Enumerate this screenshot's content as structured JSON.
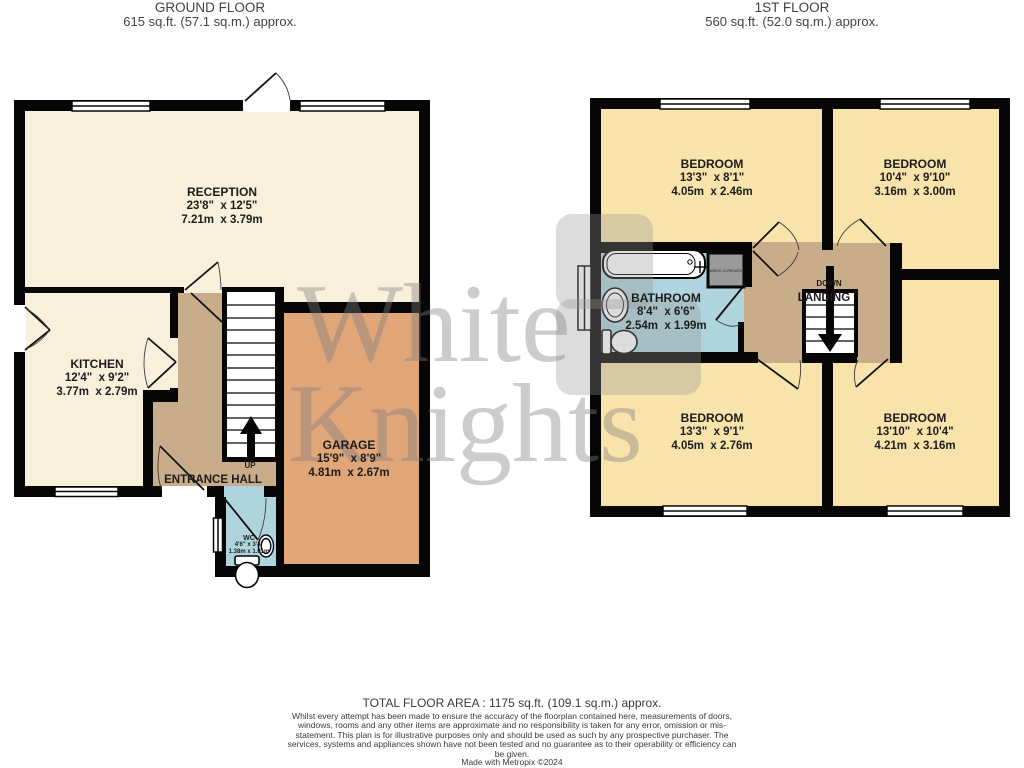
{
  "ground_floor": {
    "title": "GROUND FLOOR",
    "area": "615 sq.ft. (57.1 sq.m.) approx.",
    "reception": {
      "name": "RECEPTION",
      "imperial": "23'8\"  x 12'5\"",
      "metric": "7.21m  x 3.79m"
    },
    "kitchen": {
      "name": "KITCHEN",
      "imperial": "12'4\"  x 9'2\"",
      "metric": "3.77m  x 2.79m"
    },
    "garage": {
      "name": "GARAGE",
      "imperial": "15'9\"  x 8'9\"",
      "metric": "4.81m  x 2.67m"
    },
    "entrance_hall": {
      "name": "ENTRANCE HALL"
    },
    "wc": {
      "name": "WC",
      "imperial": "4'6\" x 3'4\"",
      "metric": "1.38m x 1.01m"
    },
    "stairs_direction": "UP"
  },
  "first_floor": {
    "title": "1ST FLOOR",
    "area": "560 sq.ft. (52.0 sq.m.) approx.",
    "bedroom_top_left": {
      "name": "BEDROOM",
      "imperial": "13'3\"  x 8'1\"",
      "metric": "4.05m  x 2.46m"
    },
    "bedroom_top_right": {
      "name": "BEDROOM",
      "imperial": "10'4\"  x 9'10\"",
      "metric": "3.16m  x 3.00m"
    },
    "bathroom": {
      "name": "BATHROOM",
      "imperial": "8'4\"  x 6'6\"",
      "metric": "2.54m  x 1.99m"
    },
    "landing": {
      "name": "LANDING"
    },
    "stairs_direction": "DOWN",
    "cupboard": "AIRING CUPBOARD",
    "bedroom_bottom_left": {
      "name": "BEDROOM",
      "imperial": "13'3\"  x 9'1\"",
      "metric": "4.05m  x 2.76m"
    },
    "bedroom_bottom_right": {
      "name": "BEDROOM",
      "imperial": "13'10\"  x 10'4\"",
      "metric": "4.21m  x 3.16m"
    }
  },
  "watermark": {
    "line1": "White",
    "line2": "Knights"
  },
  "footer": {
    "total_area": "TOTAL FLOOR AREA : 1175 sq.ft. (109.1 sq.m.) approx.",
    "disclaimer": "Whilst every attempt has been made to ensure the accuracy of the floorplan contained here, measurements of doors, windows, rooms and any other items are approximate and no responsibility is taken for any error, omission or mis-statement. This plan is for illustrative purposes only and should be used as such by any prospective purchaser. The services, systems and appliances shown have not been tested and no guarantee as to their operability or efficiency can be given.",
    "credit": "Made with Metropix ©2024"
  },
  "colors": {
    "room_cream": "#F8F0DB",
    "room_yellow": "#F8E3AB",
    "hall_tan": "#C9AC8A",
    "garage_orange": "#E0A678",
    "bath_blue": "#AFD4DD",
    "cupboard_gray": "#9A9A9A",
    "wall_black": "#060606",
    "watermark_gray": "#8C8C8C"
  }
}
